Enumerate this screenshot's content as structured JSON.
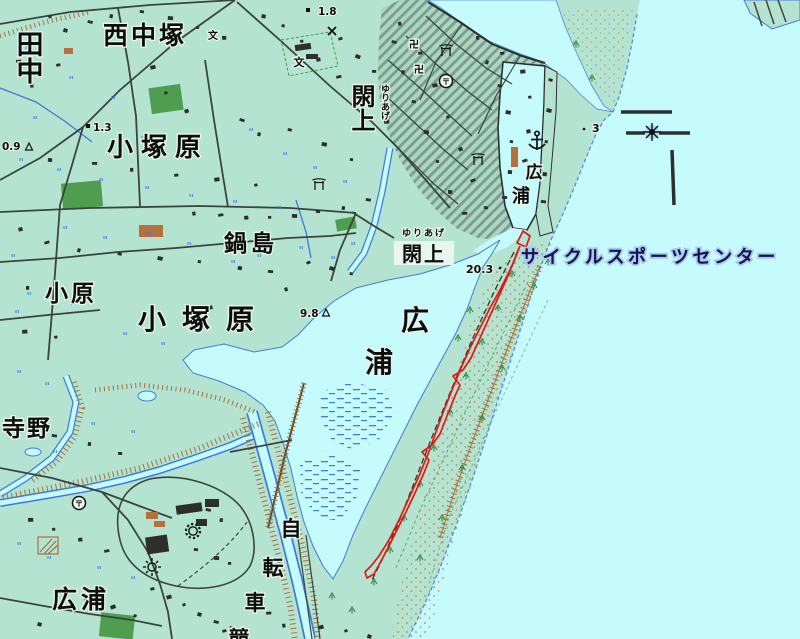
{
  "map": {
    "kind": "japanese-topographic-map",
    "area": "Yuriage / Hiroura coastal area"
  },
  "colors": {
    "sea": "#c6fbfe",
    "land": "#b5e3d1",
    "urban_base": "#a8d8c4",
    "water_edge": "#3f7cd8",
    "road": "#3a443d",
    "gps_track": "#e01812",
    "sand": "#c07838",
    "embankment": "#a6713a",
    "forest": "#4f9e4f",
    "cycle_label_halo": "#a9c6f0"
  },
  "labels": {
    "tanaka": "田中",
    "nishi_nakatsuka": "西中塚",
    "kozukahara_north": "小塚原",
    "kozukahara_south": "小塚原",
    "nabeshima": "鍋島",
    "obara": "小原",
    "terano": "寺野",
    "hiroura_southwest": "広浦",
    "yuriage_vertical": "閖上",
    "yuriage_vertical_kana": "ゆりあげ",
    "yuriage_horizontal": "閖上",
    "yuriage_horizontal_kana": "ゆりあげ",
    "hiroura_harbor_1": "広",
    "hiroura_harbor_2": "浦",
    "hiroura_lagoon_1": "広",
    "hiroura_lagoon_2": "浦",
    "jitensha_1": "自",
    "jitensha_2": "転",
    "jitensha_3": "車",
    "jitensha_4": "競",
    "cycle_sports_center": "サイクルスポーツセンター"
  },
  "elevations": {
    "spot_1_8": "1.8",
    "spot_1_3": "1.3",
    "spot_0_9": "0.9",
    "spot_9_8": "9.8",
    "spot_20_3": "20.3",
    "spot_3": "3"
  },
  "symbols": {
    "post_office_mark": "〒",
    "temple_mark": "卍",
    "school_mark": "文",
    "anchor_icon": "fishing-port",
    "lighthouse_icon": "lighthouse",
    "factory_gear_icon": "factory",
    "sun_rays_icon": "works",
    "torii_icon": "shrine",
    "police_x_icon": "police-box",
    "triangulation_icon": "triangulation-point"
  }
}
